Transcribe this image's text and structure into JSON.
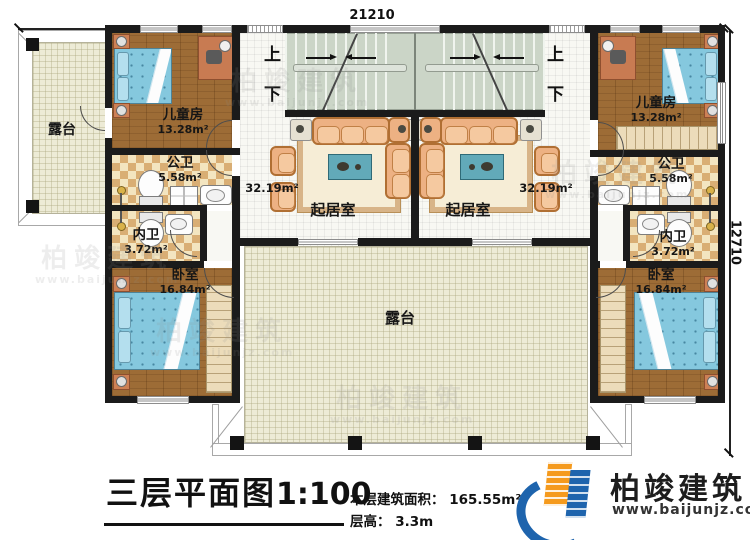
{
  "plan": {
    "dimensions": {
      "width_mm": "21210",
      "depth_mm": "12710"
    },
    "stairs": {
      "up": "上",
      "down": "下"
    },
    "rooms": {
      "terrace_left": {
        "label": "露台"
      },
      "terrace_bottom": {
        "label": "露台"
      },
      "children_left": {
        "label": "儿童房",
        "area": "13.28m²"
      },
      "children_right": {
        "label": "儿童房",
        "area": "13.28m²"
      },
      "public_bath_left": {
        "label": "公卫",
        "area": "5.58m²"
      },
      "public_bath_right": {
        "label": "公卫",
        "area": "5.58m²"
      },
      "inner_bath_left": {
        "label": "内卫",
        "area": "3.72m²"
      },
      "inner_bath_right": {
        "label": "内卫",
        "area": "3.72m²"
      },
      "bedroom_left": {
        "label": "卧室",
        "area": "16.84m²"
      },
      "bedroom_right": {
        "label": "卧室",
        "area": "16.84m²"
      },
      "living_left": {
        "label": "起居室",
        "area": "32.19m²"
      },
      "living_right": {
        "label": "起居室",
        "area": "32.19m²"
      }
    }
  },
  "title_block": {
    "title": "三层平面图",
    "scale": "1:100",
    "floor_area": "本层建筑面积： 165.55m²",
    "floor_height": "层高： 3.3m"
  },
  "logo": {
    "name": "柏竣建筑",
    "website": "www.baijunjz.com"
  },
  "watermark": {
    "text": "柏竣建筑",
    "website": "www.baijunjz.com"
  },
  "colors": {
    "logo_blue": "#1e64ad",
    "logo_orange": "#f59a1d",
    "wall": "#1b1b1b",
    "bed_blue": "#85c8de",
    "sofa_tan": "#edb183"
  }
}
